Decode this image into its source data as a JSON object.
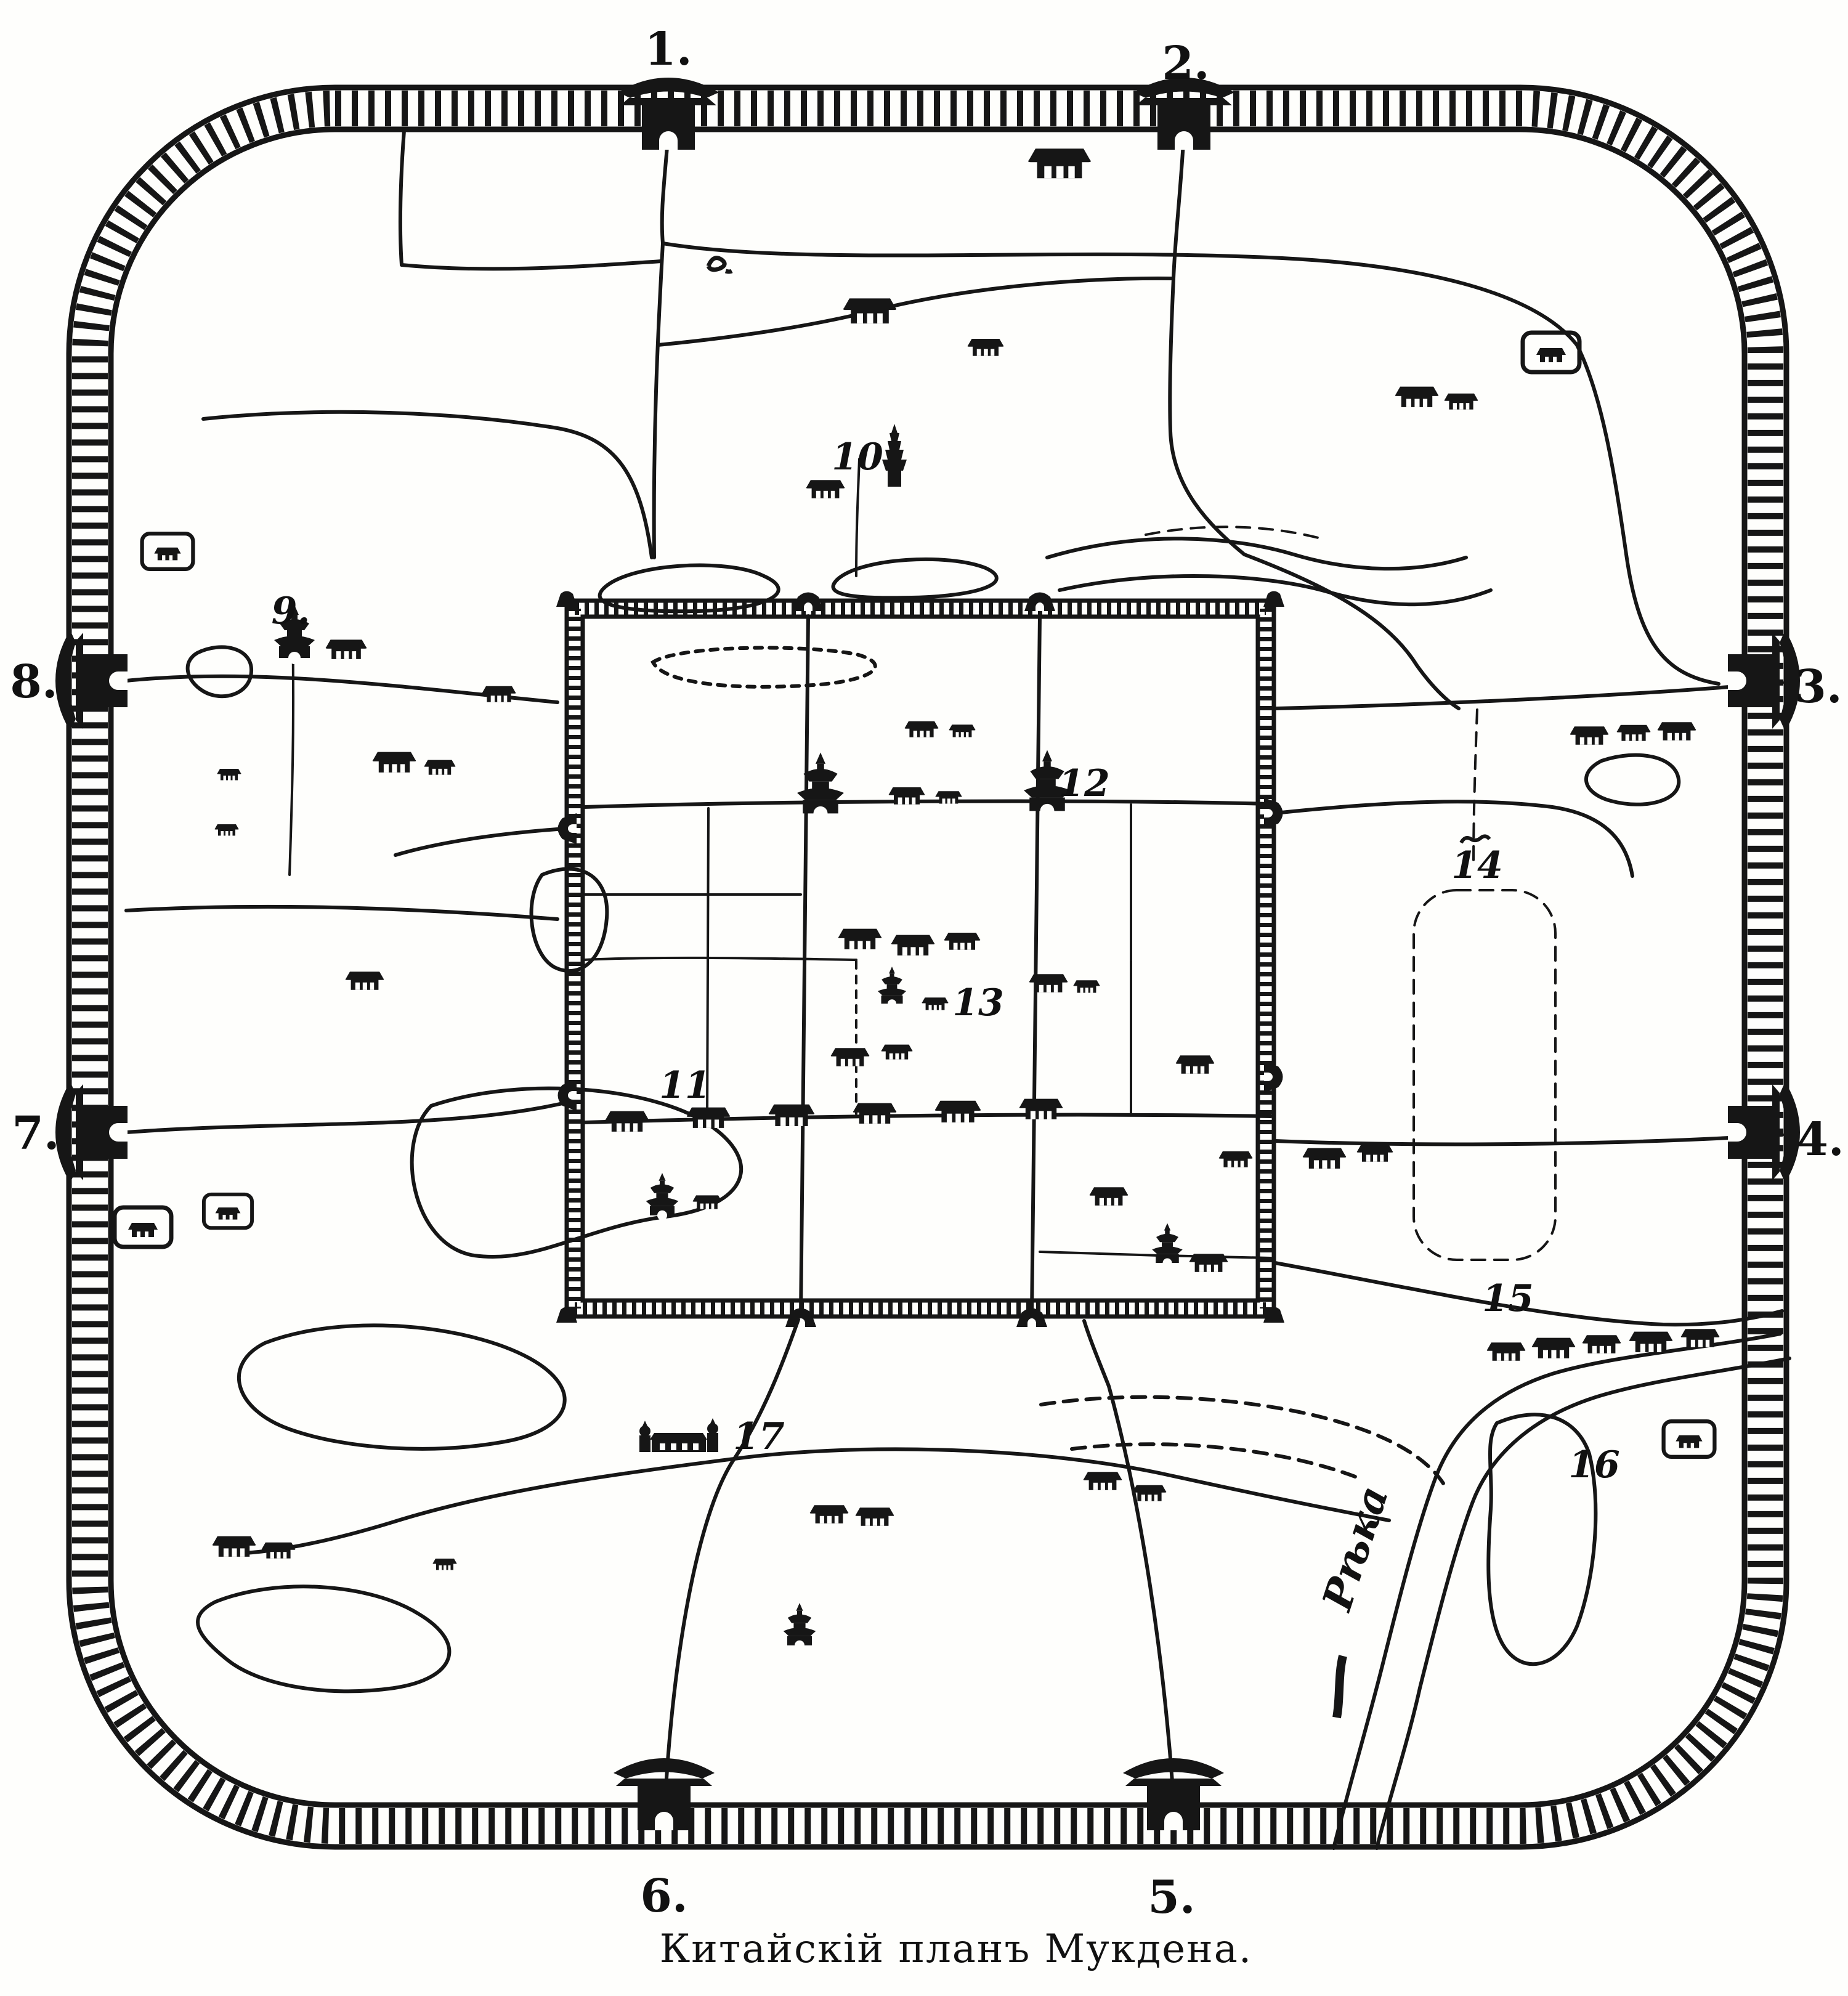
{
  "map": {
    "caption": "Китайскій планъ Мукдена.",
    "river_label": "Рѣка",
    "gates": [
      {
        "id": 1,
        "label": "1."
      },
      {
        "id": 2,
        "label": "2."
      },
      {
        "id": 3,
        "label": "3."
      },
      {
        "id": 4,
        "label": "4."
      },
      {
        "id": 5,
        "label": "5."
      },
      {
        "id": 6,
        "label": "6."
      },
      {
        "id": 7,
        "label": "7."
      },
      {
        "id": 8,
        "label": "8."
      }
    ],
    "landmarks": [
      {
        "id": 9,
        "label": "9."
      },
      {
        "id": 10,
        "label": "10"
      },
      {
        "id": 11,
        "label": "11"
      },
      {
        "id": 12,
        "label": "12"
      },
      {
        "id": 13,
        "label": "13"
      },
      {
        "id": 14,
        "label": "14"
      },
      {
        "id": 15,
        "label": "15"
      },
      {
        "id": 16,
        "label": "16"
      },
      {
        "id": 17,
        "label": "17"
      }
    ],
    "colors": {
      "ink": "#161616",
      "paper": "#fefefc"
    }
  }
}
